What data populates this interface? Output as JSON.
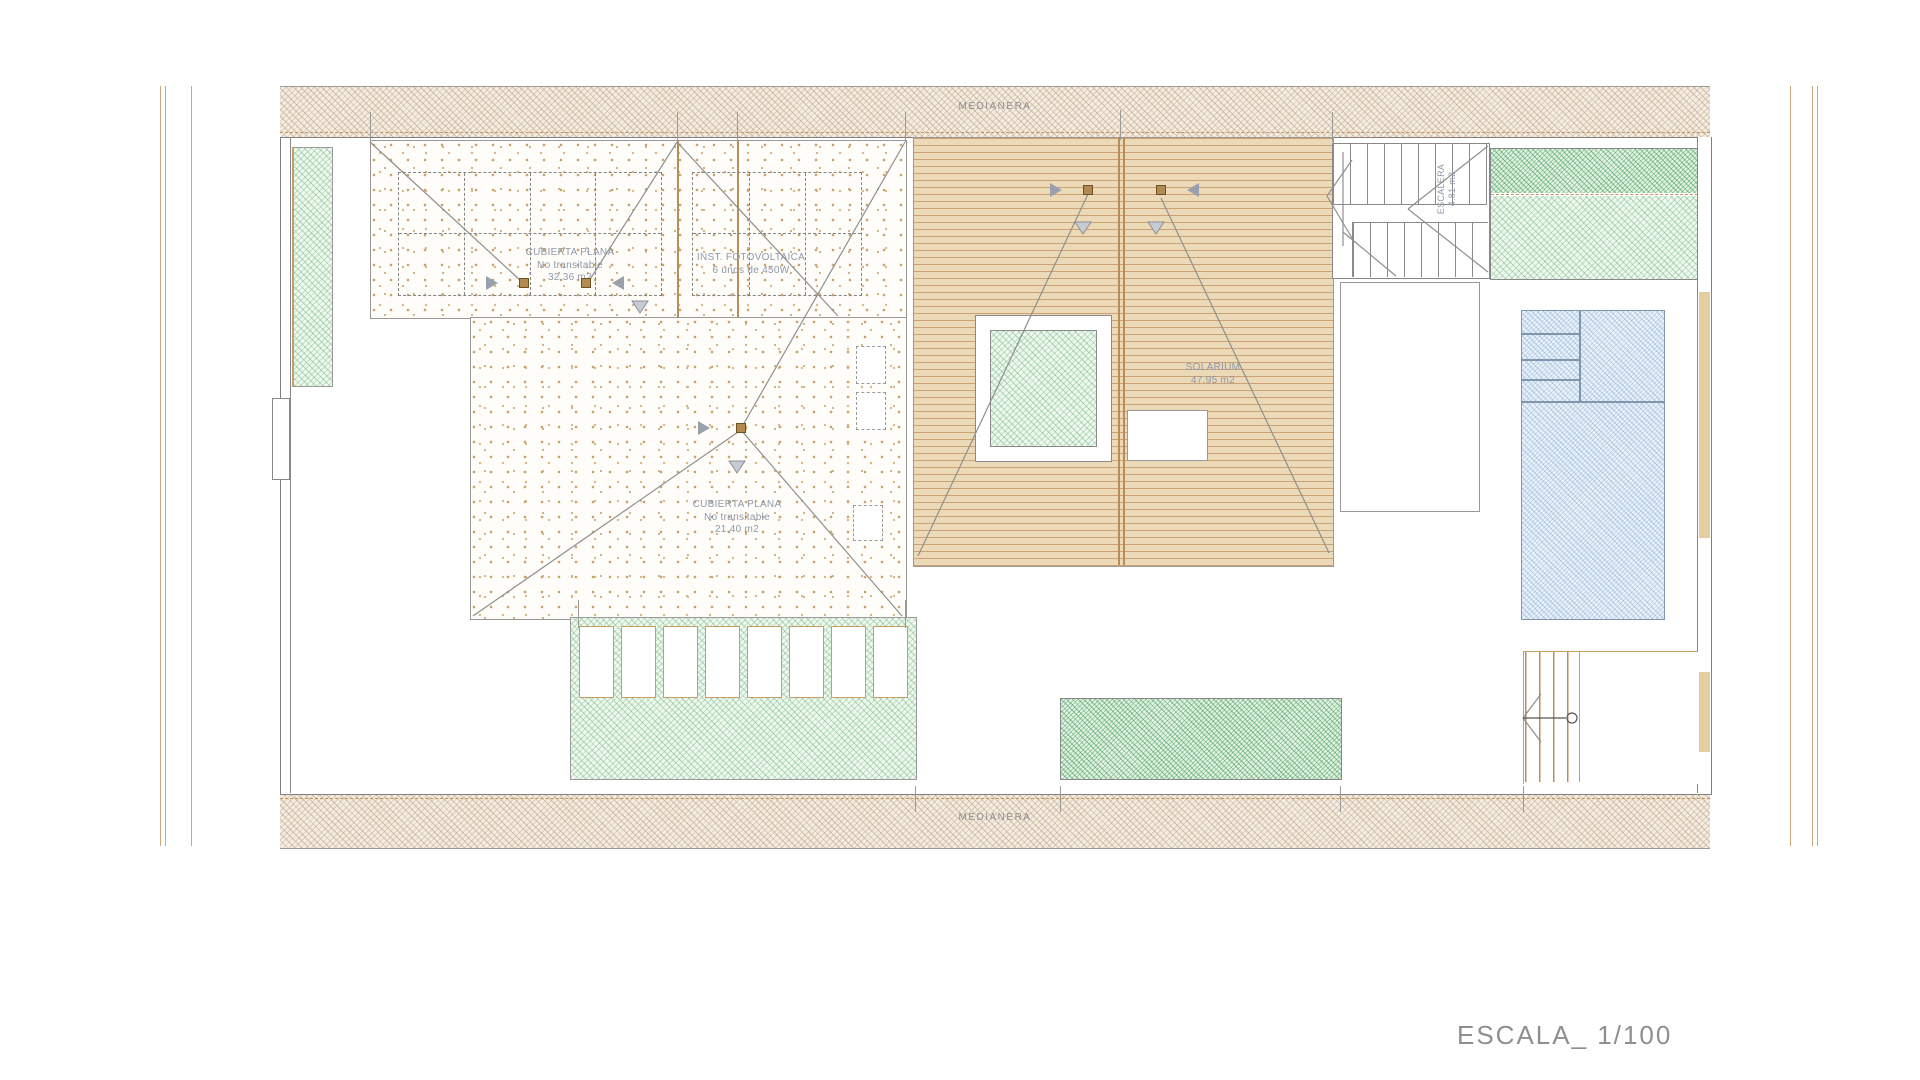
{
  "plan": {
    "party_wall_top_label": "MEDIANERA",
    "party_wall_bottom_label": "MEDIANERA",
    "roof_main": {
      "title": "CUBIERTA PLANA",
      "note": "No transitable",
      "area": "32.36 m2"
    },
    "photovoltaic": {
      "title": "INST. FOTOVOLTAICA",
      "note": "6 unds de 450W"
    },
    "roof_secondary": {
      "title": "CUBIERTA PLANA",
      "note": "No transitable",
      "area": "21.40 m2"
    },
    "solarium": {
      "title": "SOLARIUM",
      "area": "47.95 m2"
    },
    "staircase": {
      "title": "ESCALERA",
      "area": "4.81 m2"
    },
    "scale_label": "ESCALA_ 1/100",
    "colors": {
      "wall_hatch_line": "#bc9c78",
      "deck_base": "#ecd9b8",
      "deck_stripe": "#cba273",
      "green_hatch": "#60b070",
      "pool_hatch": "#789cc8",
      "tan_line": "#b98d58",
      "drawing_line": "#8a8a8a",
      "area_label_text": "#8d99aa",
      "gray_text": "#8f8f8f"
    }
  }
}
